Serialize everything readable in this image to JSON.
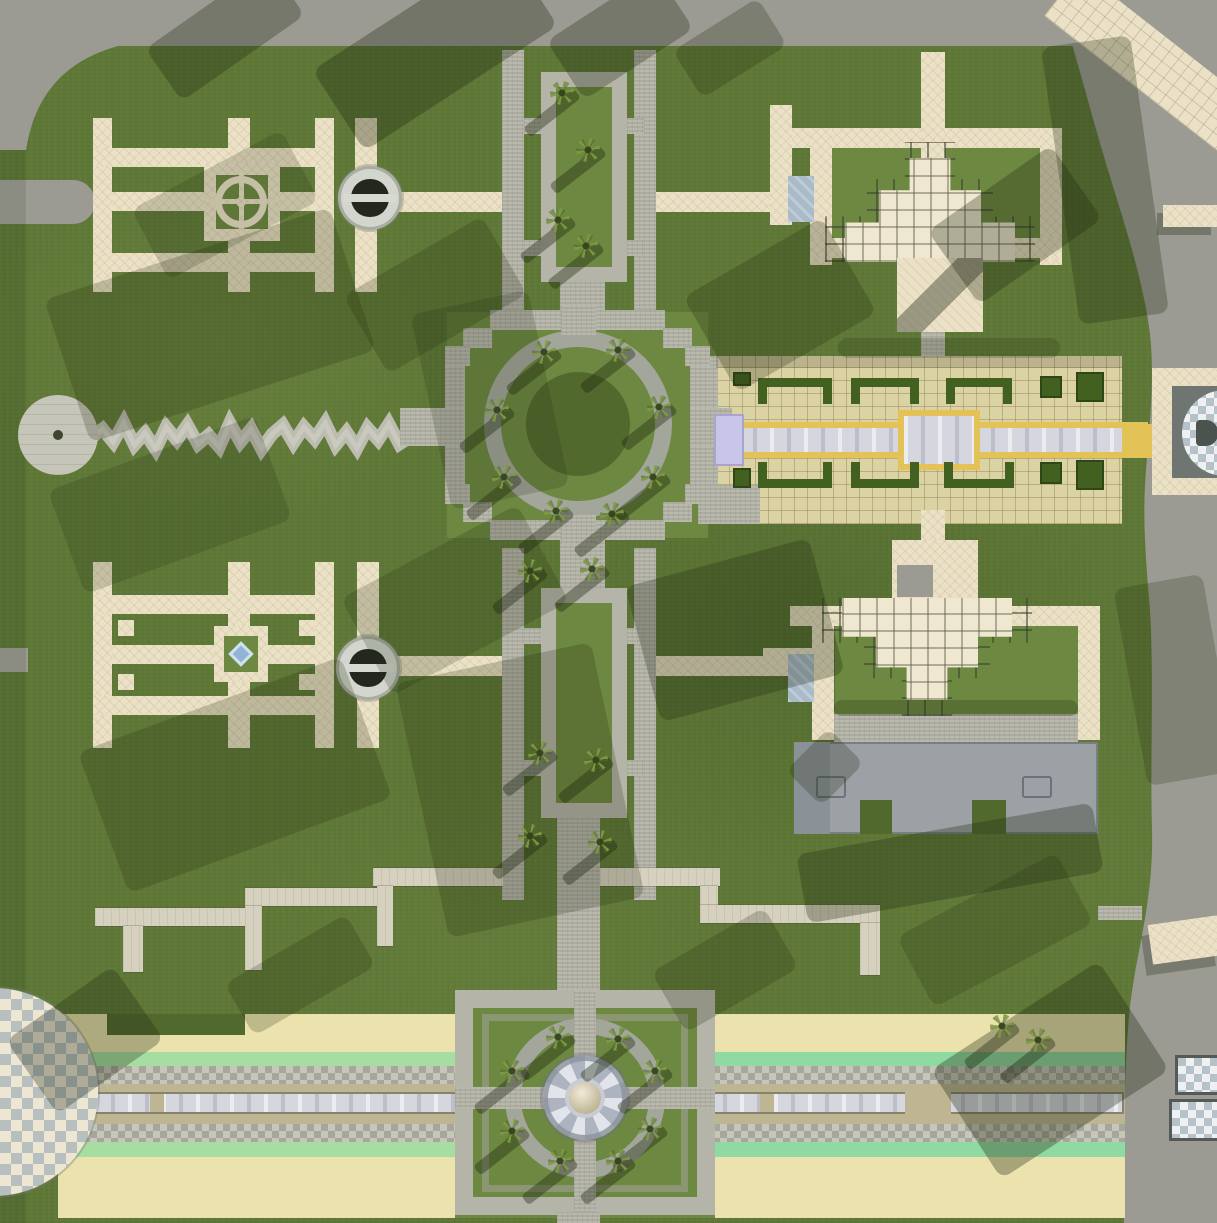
{
  "scene": {
    "type": "top-down-aerial-render",
    "description": "Formal park complex with symmetrical char-bagh gardens, central circular plaza, reflecting pool, pergola pavilions, palm-lined avenues and a beach promenade"
  },
  "colors": {
    "grass": "#5e7836",
    "grassLight": "#6d8841",
    "grassDark": "#52692e",
    "road": "#9c9b93",
    "stone": "#b5b4a8",
    "stoneDark": "#a3a79b",
    "cream": "#ebe1c6",
    "creamShade": "#efe7d0",
    "tan": "#dcd3a4",
    "sand": "#ebe2ae",
    "mint": "#a5dea0",
    "mint2": "#8fd9a2",
    "gold": "#e3c257",
    "water": "#d6d6de",
    "lavender": "#c9c5e8",
    "hedge": "#42601f",
    "concrete": "#9ba1a5",
    "concrete2": "#8b9297",
    "ramp": "#a9bac9",
    "pond": "#8fb4d8",
    "ltconc": "#d6d1bf",
    "checkA": "#ece6d3",
    "checkB": "#b7c0bf",
    "walkA": "#c7c6ba",
    "walkB": "#a7a69a",
    "discA": "#eef0f2",
    "discB": "#b5c2c9",
    "fountDark": "#23281f"
  },
  "map": {
    "features": [
      "top-road",
      "right-curved-road",
      "diagonal-tiled-crossing",
      "parterre-garden-northwest",
      "parterre-garden-southwest",
      "sculpture-fountain-north",
      "sculpture-fountain-south",
      "palm-avenue-north",
      "palm-avenue-middle",
      "central-circular-plaza",
      "reflecting-pool-court",
      "pergola-pavilion-northeast",
      "pergola-pavilion-southeast",
      "concrete-building-southeast",
      "zigzag-stream",
      "stream-circle-plaza",
      "beach-promenade",
      "fountain-plaza-south",
      "checkered-circle-southwest",
      "checkered-disc-pavilion-east"
    ],
    "trees": [
      [
        562,
        93
      ],
      [
        588,
        150
      ],
      [
        558,
        220
      ],
      [
        586,
        246
      ],
      [
        544,
        352
      ],
      [
        618,
        350
      ],
      [
        497,
        410
      ],
      [
        659,
        407
      ],
      [
        504,
        477
      ],
      [
        653,
        477
      ],
      [
        556,
        511
      ],
      [
        612,
        514
      ],
      [
        530,
        571
      ],
      [
        592,
        569
      ],
      [
        540,
        753
      ],
      [
        596,
        760
      ],
      [
        530,
        836
      ],
      [
        600,
        842
      ],
      [
        558,
        1037
      ],
      [
        618,
        1039
      ],
      [
        512,
        1071
      ],
      [
        655,
        1071
      ],
      [
        512,
        1131
      ],
      [
        650,
        1129
      ],
      [
        560,
        1161
      ],
      [
        618,
        1161
      ],
      [
        1002,
        1026
      ],
      [
        1038,
        1040
      ]
    ],
    "shadows": [
      [
        150,
        0,
        150,
        64,
        -35,
        0.3
      ],
      [
        320,
        0,
        230,
        96,
        -33,
        0.33
      ],
      [
        555,
        0,
        130,
        70,
        -33,
        0.3
      ],
      [
        680,
        20,
        100,
        56,
        -32,
        0.25
      ],
      [
        60,
        250,
        300,
        150,
        -18,
        0.22
      ],
      [
        140,
        165,
        170,
        80,
        -28,
        0.18
      ],
      [
        355,
        250,
        160,
        90,
        -30,
        0.22
      ],
      [
        430,
        300,
        120,
        200,
        -12,
        0.18
      ],
      [
        60,
        450,
        220,
        110,
        -20,
        0.18
      ],
      [
        95,
        700,
        280,
        150,
        -20,
        0.22
      ],
      [
        355,
        545,
        200,
        110,
        -28,
        0.2
      ],
      [
        640,
        560,
        190,
        140,
        -15,
        0.28
      ],
      [
        420,
        660,
        200,
        260,
        -12,
        0.22
      ],
      [
        700,
        250,
        160,
        110,
        -30,
        0.25
      ],
      [
        940,
        180,
        150,
        90,
        -35,
        0.3
      ],
      [
        1060,
        40,
        90,
        280,
        -8,
        0.28
      ],
      [
        800,
        828,
        300,
        70,
        -10,
        0.3
      ],
      [
        905,
        890,
        180,
        80,
        -28,
        0.2
      ],
      [
        950,
        1005,
        200,
        130,
        -33,
        0.33
      ],
      [
        230,
        945,
        140,
        60,
        -30,
        0.22
      ],
      [
        660,
        935,
        130,
        70,
        -30,
        0.22
      ],
      [
        20,
        995,
        130,
        90,
        -35,
        0.3
      ],
      [
        1130,
        580,
        90,
        200,
        -10,
        0.22
      ],
      [
        838,
        338,
        222,
        20,
        0,
        0.2
      ],
      [
        834,
        700,
        244,
        16,
        0,
        0.25
      ],
      [
        795,
        742,
        60,
        50,
        -45,
        0.25
      ]
    ],
    "hedges": [
      [
        758,
        378,
        74,
        26,
        "n"
      ],
      [
        851,
        378,
        68,
        26,
        "n"
      ],
      [
        946,
        378,
        66,
        26,
        "n"
      ],
      [
        1040,
        376,
        22,
        22,
        "sq"
      ],
      [
        1076,
        372,
        28,
        30,
        "sq"
      ],
      [
        758,
        462,
        74,
        26,
        "s"
      ],
      [
        851,
        462,
        68,
        26,
        "s"
      ],
      [
        944,
        462,
        70,
        26,
        "s"
      ],
      [
        1040,
        462,
        22,
        22,
        "sq"
      ],
      [
        1076,
        460,
        28,
        30,
        "sq"
      ],
      [
        733,
        372,
        18,
        14,
        "sq"
      ],
      [
        733,
        468,
        18,
        20,
        "sq"
      ]
    ],
    "stepped_path": [
      [
        95,
        908,
        155,
        18
      ],
      [
        123,
        926,
        20,
        46
      ],
      [
        245,
        888,
        135,
        18
      ],
      [
        245,
        906,
        17,
        64
      ],
      [
        373,
        868,
        130,
        18
      ],
      [
        377,
        886,
        16,
        60
      ],
      [
        600,
        868,
        120,
        18
      ],
      [
        700,
        886,
        18,
        20
      ],
      [
        700,
        905,
        180,
        18
      ],
      [
        860,
        923,
        20,
        52
      ]
    ],
    "zigzag_y": [
      0,
      -8,
      5,
      -14,
      8,
      -4,
      12,
      -10,
      3,
      -12,
      7,
      -2,
      10,
      -14,
      5,
      -8,
      12,
      -3,
      -12,
      6,
      -10,
      2,
      -14,
      8,
      -5,
      11,
      -9,
      3,
      -13,
      7,
      0
    ]
  }
}
